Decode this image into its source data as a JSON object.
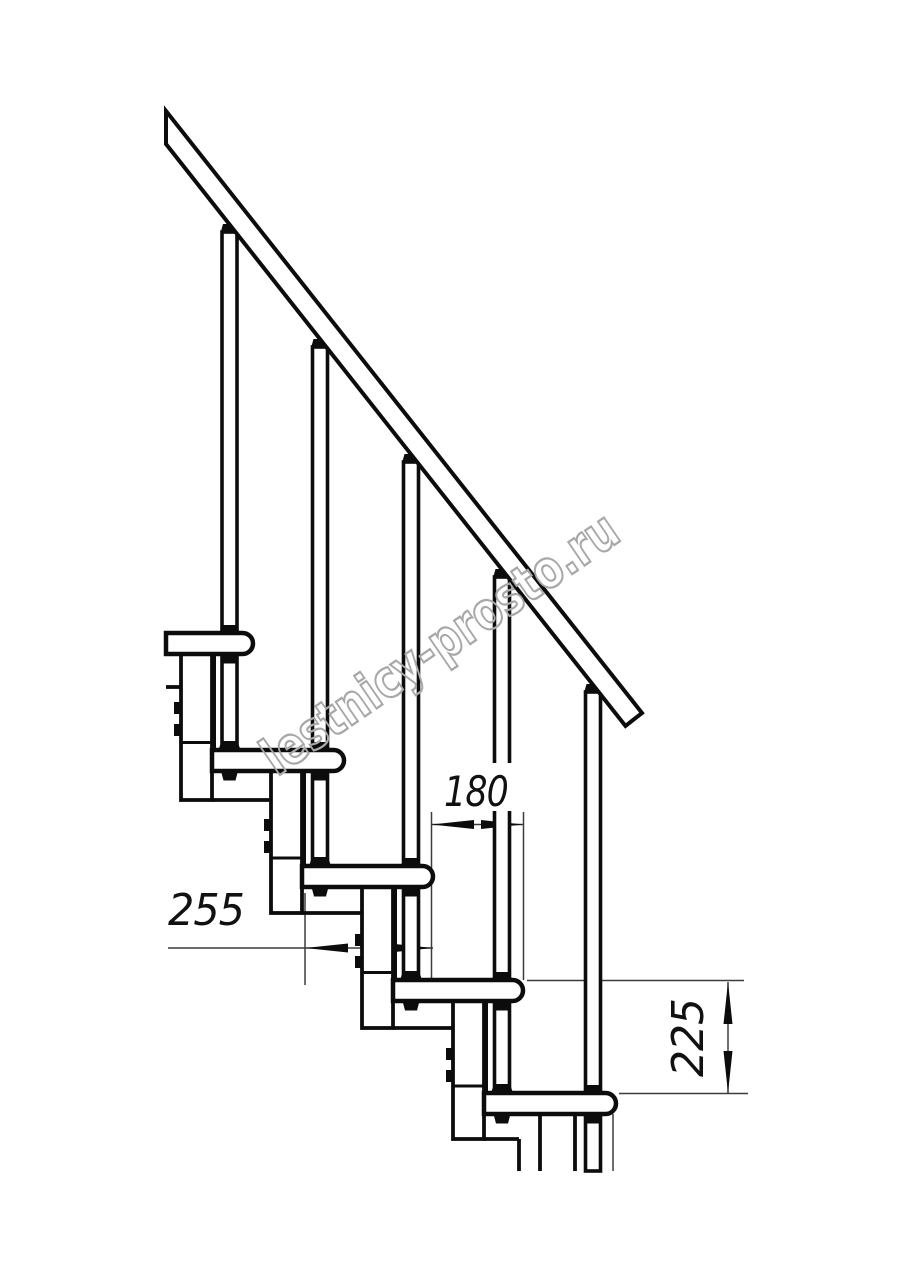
{
  "drawing": {
    "watermark": "lestnicy-prosto.ru",
    "dimension_labels": {
      "run": "180",
      "depth": "255",
      "rise": "225"
    },
    "colors": {
      "line": "#0c0c0c",
      "dimension_line": "#3c3c3c",
      "watermark": "#a8a8a8"
    }
  }
}
